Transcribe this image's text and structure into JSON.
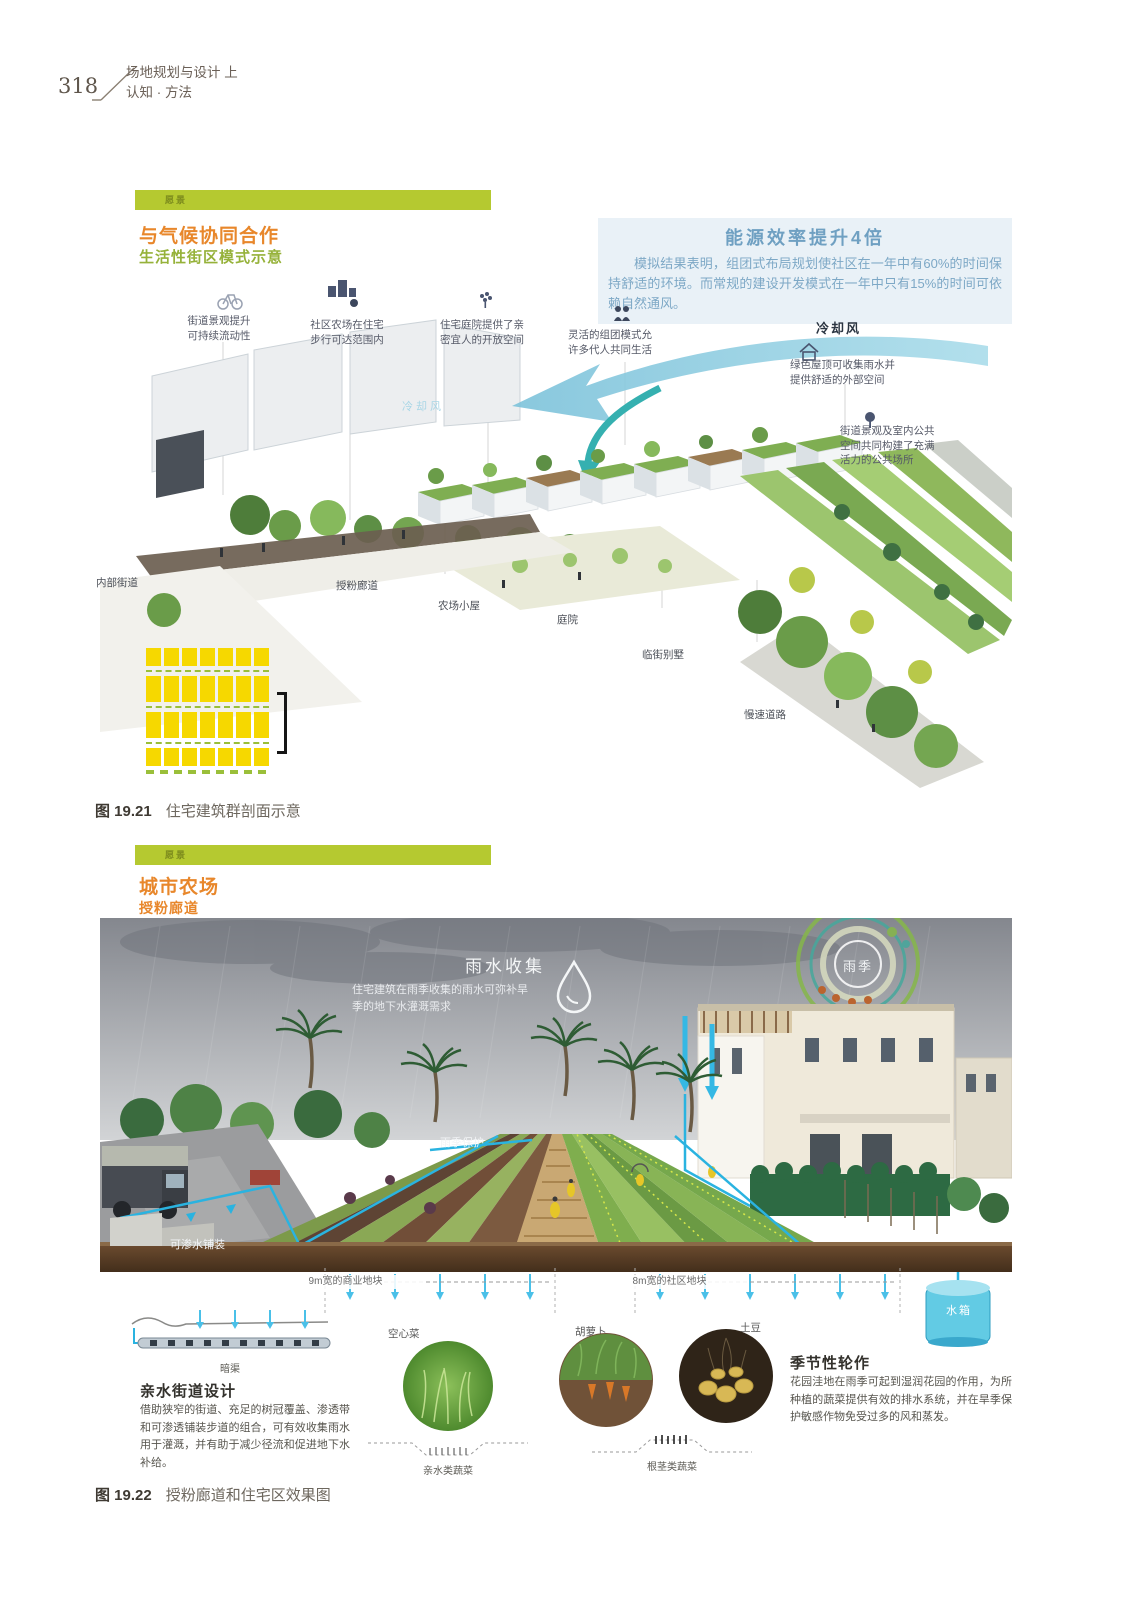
{
  "page": {
    "number": "318",
    "header_line1": "场地规划与设计 上",
    "header_line2": "认知 · 方法"
  },
  "colors": {
    "accent_green_bar": "#b5c930",
    "accent_orange": "#e8872b",
    "subtitle_green": "#96b23a",
    "info_blue": "#6fa0c2",
    "pipe_cyan": "#2ab3e0",
    "plan_yellow": "#f6d800"
  },
  "figure1": {
    "tag": "愿景",
    "title": "与气候协同合作",
    "subtitle": "生活性街区模式示意",
    "energy_title": "能源效率提升4倍",
    "energy_body": "模拟结果表明，组团式布局规划使社区在一年中有60%的时间保持舒适的环境。而常规的建设开发模式在一年中只有15%的时间可依赖自然通风。",
    "callouts": {
      "street": "街道景观提升\n可持续流动性",
      "farm": "社区农场在住宅\n步行可达范围内",
      "courtyard": "住宅庭院提供了亲\n密宜人的开放空间",
      "cluster": "灵活的组团模式允\n许多代人共同生活",
      "cooling_wind": "冷却风",
      "green_roof": "绿色屋顶可收集雨水并\n提供舒适的外部空间",
      "public_space": "街道景观及室内公共\n空间共同构建了充满\n活力的公共场所"
    },
    "site_labels": {
      "inner_street": "内部街道",
      "pollination_corridor": "授粉廊道",
      "farm_cabin": "农场小屋",
      "courtyard": "庭院",
      "street_villa": "临街别墅",
      "slow_road": "慢速道路",
      "cooling_wind_watermark": "冷却风"
    },
    "caption_id": "图 19.21",
    "caption_text": "住宅建筑群剖面示意"
  },
  "figure2": {
    "tag": "愿景",
    "title": "城市农场",
    "subtitle": "授粉廊道",
    "rain_title": "雨水收集",
    "rain_body": "住宅建筑在雨季收集的雨水可弥补旱\n季的地下水灌溉需求",
    "season_label": "雨季",
    "labels": {
      "rain_protection": "雨季保护",
      "permeable_paving": "可渗水铺装",
      "commercial_plot": "9m宽的商业地块",
      "community_plot": "8m宽的社区地块",
      "water_tank": "水箱",
      "culvert": "暗渠"
    },
    "veg_labels": {
      "water_spinach": "空心菜",
      "carrot": "胡萝卜",
      "potato": "土豆"
    },
    "veg_captions": {
      "hydrophilic": "亲水类蔬菜",
      "root": "根茎类蔬菜"
    },
    "left_block": {
      "title": "亲水街道设计",
      "body": "借助狭窄的街道、充足的树冠覆盖、渗透带和可渗透铺装步道的组合，可有效收集雨水用于灌溉，并有助于减少径流和促进地下水补给。"
    },
    "right_block": {
      "title": "季节性轮作",
      "body": "花园洼地在雨季可起到湿润花园的作用，为所种植的蔬菜提供有效的排水系统，并在旱季保护敏感作物免受过多的风和蒸发。"
    },
    "caption_id": "图 19.22",
    "caption_text": "授粉廊道和住宅区效果图"
  }
}
